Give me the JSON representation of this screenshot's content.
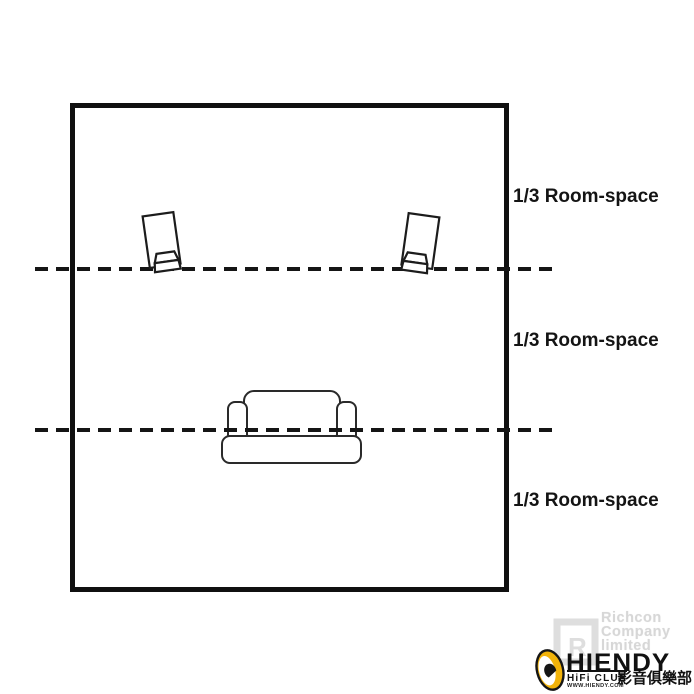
{
  "canvas": {
    "background": "#ffffff",
    "ink": "#141414"
  },
  "diagram": {
    "region_labels": [
      {
        "text": "1/3 Room-space"
      },
      {
        "text": "1/3 Room-space"
      },
      {
        "text": "1/3 Room-space"
      }
    ],
    "icons": {
      "left_speaker": "left-speaker-icon",
      "right_speaker": "right-speaker-icon",
      "sofa": "sofa-icon",
      "third_lines": "dashed-third-line"
    }
  },
  "watermark": {
    "richcon": {
      "initial": "R",
      "line1": "Richcon",
      "line2": "Company",
      "line3": "limited",
      "color": "#D9D9D9"
    },
    "hiendy": {
      "wordmark": "HIENDY",
      "club": "HiFi CLUB",
      "url": "WWW.HIENDY.COM",
      "cjk": "影音俱樂部",
      "gold": "#F2B30A"
    }
  }
}
